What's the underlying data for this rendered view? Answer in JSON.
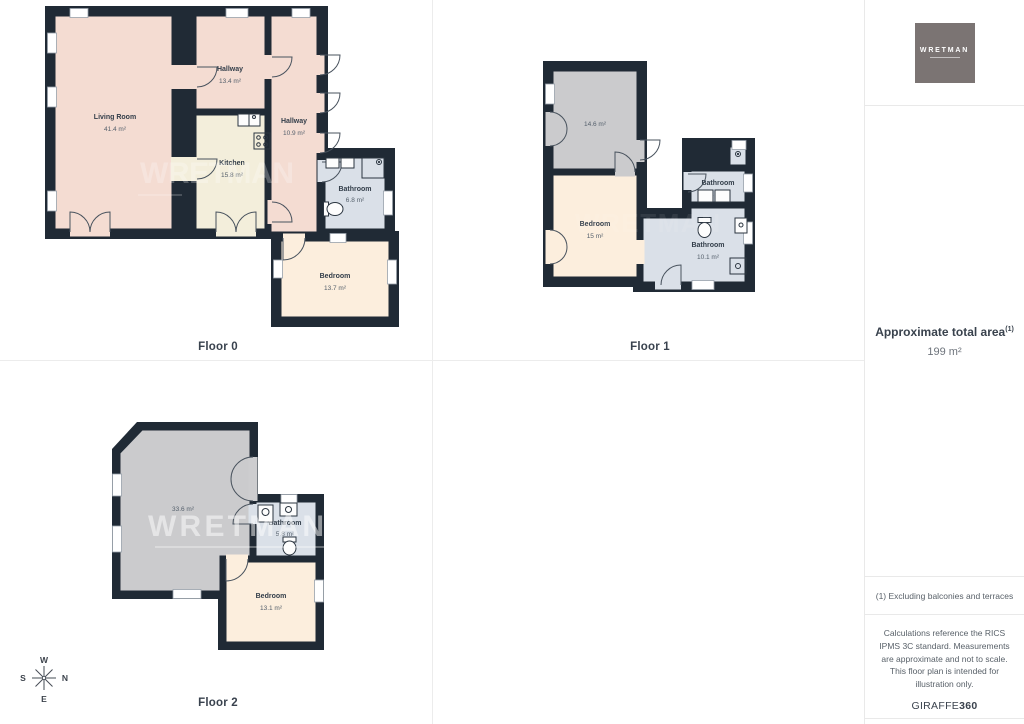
{
  "floors": [
    {
      "label": "Floor 0",
      "rooms": [
        {
          "name": "Living Room",
          "area": "41.4 m²"
        },
        {
          "name": "Hallway",
          "area": "13.4 m²"
        },
        {
          "name": "Hallway",
          "area": "10.9 m²"
        },
        {
          "name": "Kitchen",
          "area": "15.8 m²"
        },
        {
          "name": "Bathroom",
          "area": "6.8 m²"
        },
        {
          "name": "Bedroom",
          "area": "13.7 m²"
        }
      ]
    },
    {
      "label": "Floor 1",
      "rooms": [
        {
          "name": "",
          "area": "14.6 m²"
        },
        {
          "name": "Bedroom",
          "area": "15 m²"
        },
        {
          "name": "Bathroom",
          "area": "4.8 m²"
        },
        {
          "name": "Bathroom",
          "area": "10.1 m²"
        }
      ]
    },
    {
      "label": "Floor 2",
      "rooms": [
        {
          "name": "",
          "area": "33.6 m²"
        },
        {
          "name": "Bathroom",
          "area": "5.8 m²"
        },
        {
          "name": "Bedroom",
          "area": "13.1 m²"
        }
      ]
    }
  ],
  "sidebar": {
    "logo_text": "WRETMAN",
    "total_area_label": "Approximate total area",
    "total_area_sup": "(1)",
    "total_area_value": "199 m²",
    "footnote": "(1) Excluding balconies and terraces",
    "disclaimer": "Calculations reference the RICS IPMS 3C standard. Measurements are approximate and not to scale. This floor plan is intended for illustration only.",
    "brand_name": "GIRAFFE",
    "brand_suffix": "360"
  },
  "compass": {
    "n": "N",
    "s": "S",
    "e": "E",
    "w": "W"
  },
  "watermark": "WRETMAN",
  "colors": {
    "wall": "#202a35",
    "room_pink": "#f4dcd2",
    "room_cream_kitchen": "#f3eedb",
    "room_cream": "#fceedd",
    "room_blue": "#dae0e8",
    "room_gray": "#cbcbcd",
    "background": "#ffffff",
    "divider": "#e9e9e9",
    "logo_bg": "#7b7473"
  }
}
